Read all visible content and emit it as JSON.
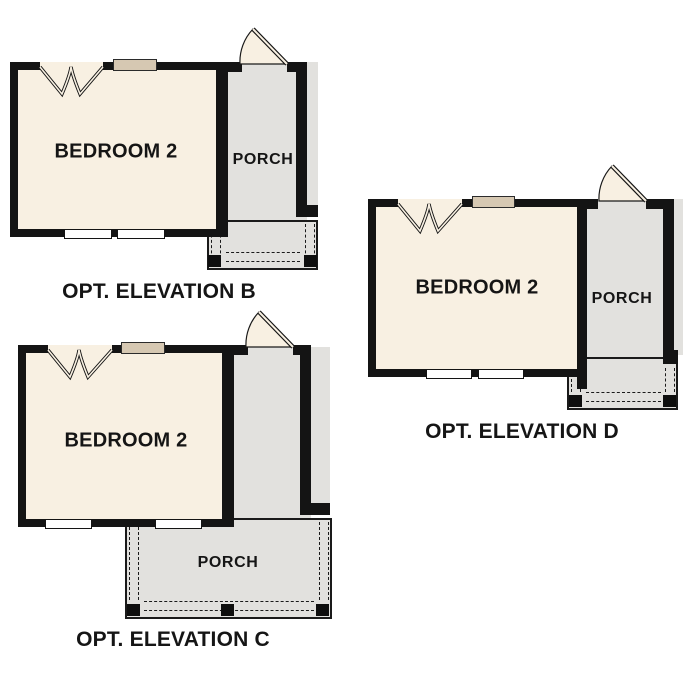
{
  "colors": {
    "wall": "#141414",
    "room_fill": "#f8f0e2",
    "porch_fill": "#e2e1de",
    "header_fill": "#d6c8b2",
    "background": "#ffffff"
  },
  "plans": [
    {
      "caption": "OPT. ELEVATION B",
      "room_label": "BEDROOM 2",
      "porch_label": "PORCH"
    },
    {
      "caption": "OPT. ELEVATION C",
      "room_label": "BEDROOM 2",
      "porch_label": "PORCH"
    },
    {
      "caption": "OPT. ELEVATION D",
      "room_label": "BEDROOM 2",
      "porch_label": "PORCH"
    }
  ]
}
